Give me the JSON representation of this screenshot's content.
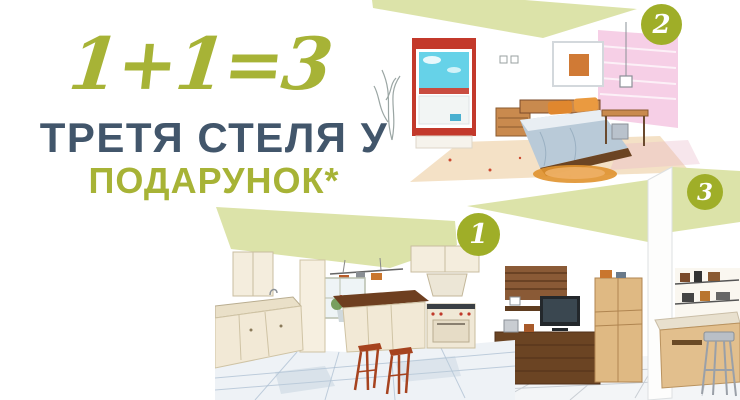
{
  "banner": {
    "equation": "1+1=3",
    "headline_line1": "ТРЕТЯ СТЕЛЯ У",
    "headline_line2": "ПОДАРУНОК*"
  },
  "badges": [
    {
      "label": "1",
      "illustration": "kitchen-sketch"
    },
    {
      "label": "2",
      "illustration": "bedroom-sketch"
    },
    {
      "label": "3",
      "illustration": "living-room-sketch"
    }
  ],
  "colors": {
    "accent_olive": "#a7b336",
    "badge_olive": "#9fae28",
    "pale_green_ceiling": "#dce3a9",
    "headline_slate": "#42566b",
    "background": "#ffffff"
  }
}
